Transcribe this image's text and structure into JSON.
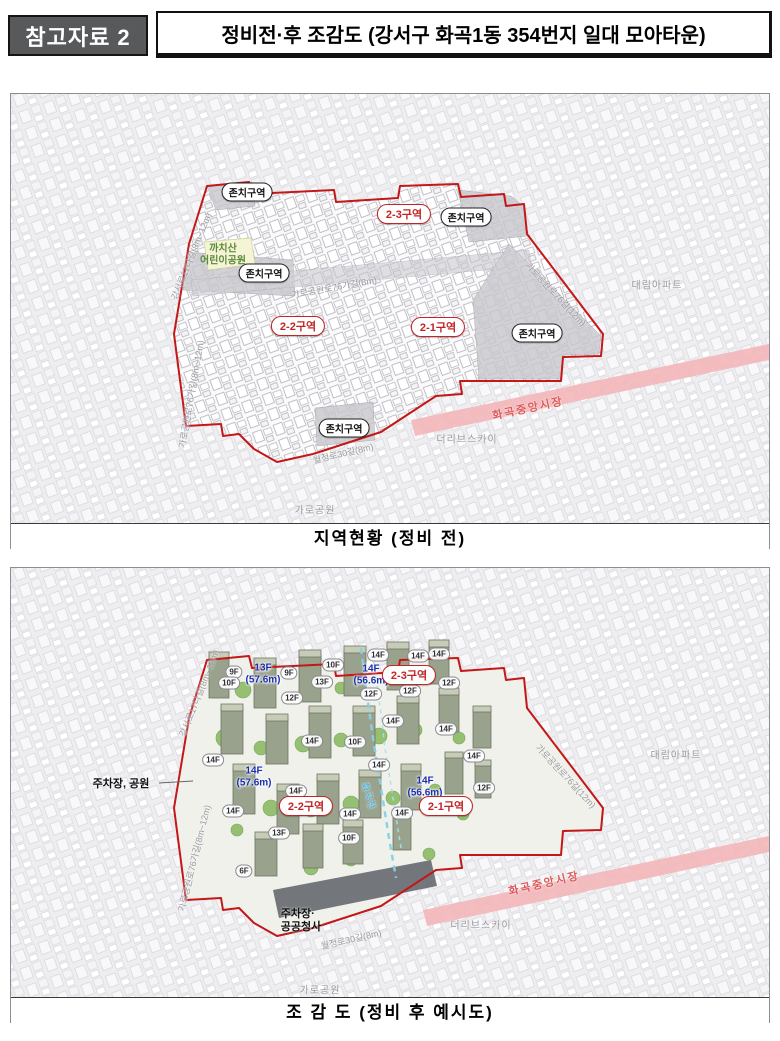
{
  "header": {
    "badge": "참고자료 2",
    "title": "정비전·후 조감도 (강서구 화곡1동 354번지 일대 모아타운)"
  },
  "colors": {
    "boundary_red": "#c31718",
    "zone_text_red": "#c22525",
    "market_band_pink": "#f3b6b9",
    "market_text_red": "#dd5a5a",
    "height_label_blue": "#1b2fae",
    "park_label_green": "#5a8a3c",
    "street_label_gray": "#9a9aa2",
    "header_badge_gray": "#58595b"
  },
  "before": {
    "caption": "지역현황 (정비 전)",
    "zones": [
      {
        "label": "2-3구역"
      },
      {
        "label": "2-2구역"
      },
      {
        "label": "2-1구역"
      }
    ],
    "preserved": [
      {
        "label": "존치구역"
      },
      {
        "label": "존치구역"
      },
      {
        "label": "존치구역"
      },
      {
        "label": "존치구역"
      },
      {
        "label": "존치구역"
      }
    ],
    "park": {
      "line1": "까치산",
      "line2": "어린이공원"
    },
    "streets": [
      {
        "label": "강서로17다길(8m~12m)"
      },
      {
        "label": "가로공원로76가길(8m)"
      },
      {
        "label": "가로공원로76길(12m)"
      },
      {
        "label": "가로공원로76가길(8m~12m)"
      },
      {
        "label": "월정로30길(8m)"
      }
    ],
    "places": [
      {
        "label": "화곡중앙시장"
      },
      {
        "label": "더리브스카이"
      },
      {
        "label": "대림아파트"
      },
      {
        "label": "가로공원"
      }
    ]
  },
  "after": {
    "caption": "조 감 도 (정비 후 예시도)",
    "zones": [
      {
        "label": "2-3구역"
      },
      {
        "label": "2-2구역"
      },
      {
        "label": "2-1구역"
      }
    ],
    "heights": [
      {
        "floors": "13F",
        "height": "(57.6m)"
      },
      {
        "floors": "14F",
        "height": "(56.6m)"
      },
      {
        "floors": "14F",
        "height": "(57.6m)"
      },
      {
        "floors": "14F",
        "height": "(56.6m)"
      }
    ],
    "floor_tags": [
      "9F",
      "10F",
      "9F",
      "10F",
      "13F",
      "12F",
      "14F",
      "14F",
      "12F",
      "12F",
      "14F",
      "12F",
      "14F",
      "14F",
      "14F",
      "10F",
      "14F",
      "14F",
      "14F",
      "14F",
      "14F",
      "13F",
      "14F",
      "10F",
      "14F",
      "12F",
      "6F"
    ],
    "notes": {
      "parking_park": "주차장, 공원",
      "parking_public_line1": "주차장·",
      "parking_public_line2": "공공청사"
    },
    "stream": "화곡천",
    "streets": [
      {
        "label": "강서로17다길(8m~12m)"
      },
      {
        "label": "가로공원로76가길(8m~12m)"
      },
      {
        "label": "가로공원로76길(12m)"
      },
      {
        "label": "월정로30길(8m)"
      }
    ],
    "places": [
      {
        "label": "화곡중앙시장"
      },
      {
        "label": "더리브스카이"
      },
      {
        "label": "대림아파트"
      },
      {
        "label": "가로공원"
      }
    ]
  }
}
